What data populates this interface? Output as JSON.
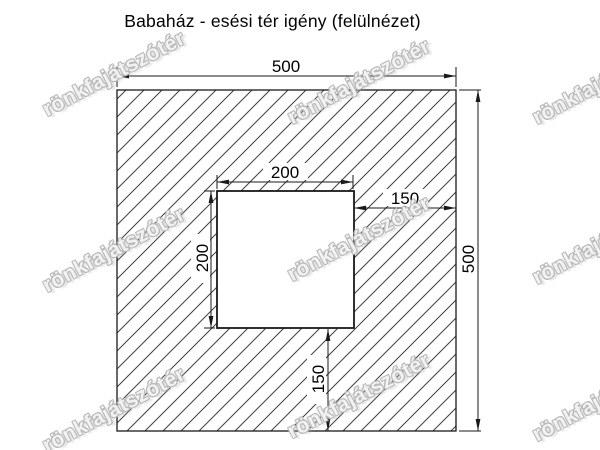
{
  "title": "Babaház - esési tér igény (felülnézet)",
  "watermark": {
    "text": "rönkfajátszótér"
  },
  "dimensions": {
    "outer_width": "500",
    "outer_height": "500",
    "inner_width": "200",
    "inner_height": "200",
    "right_offset": "150",
    "bottom_offset": "150"
  },
  "colors": {
    "background": "#ffffff",
    "line": "#1a1a1a",
    "hatch": "#3f3f3f",
    "watermark_outline": "#b9b9b9"
  }
}
